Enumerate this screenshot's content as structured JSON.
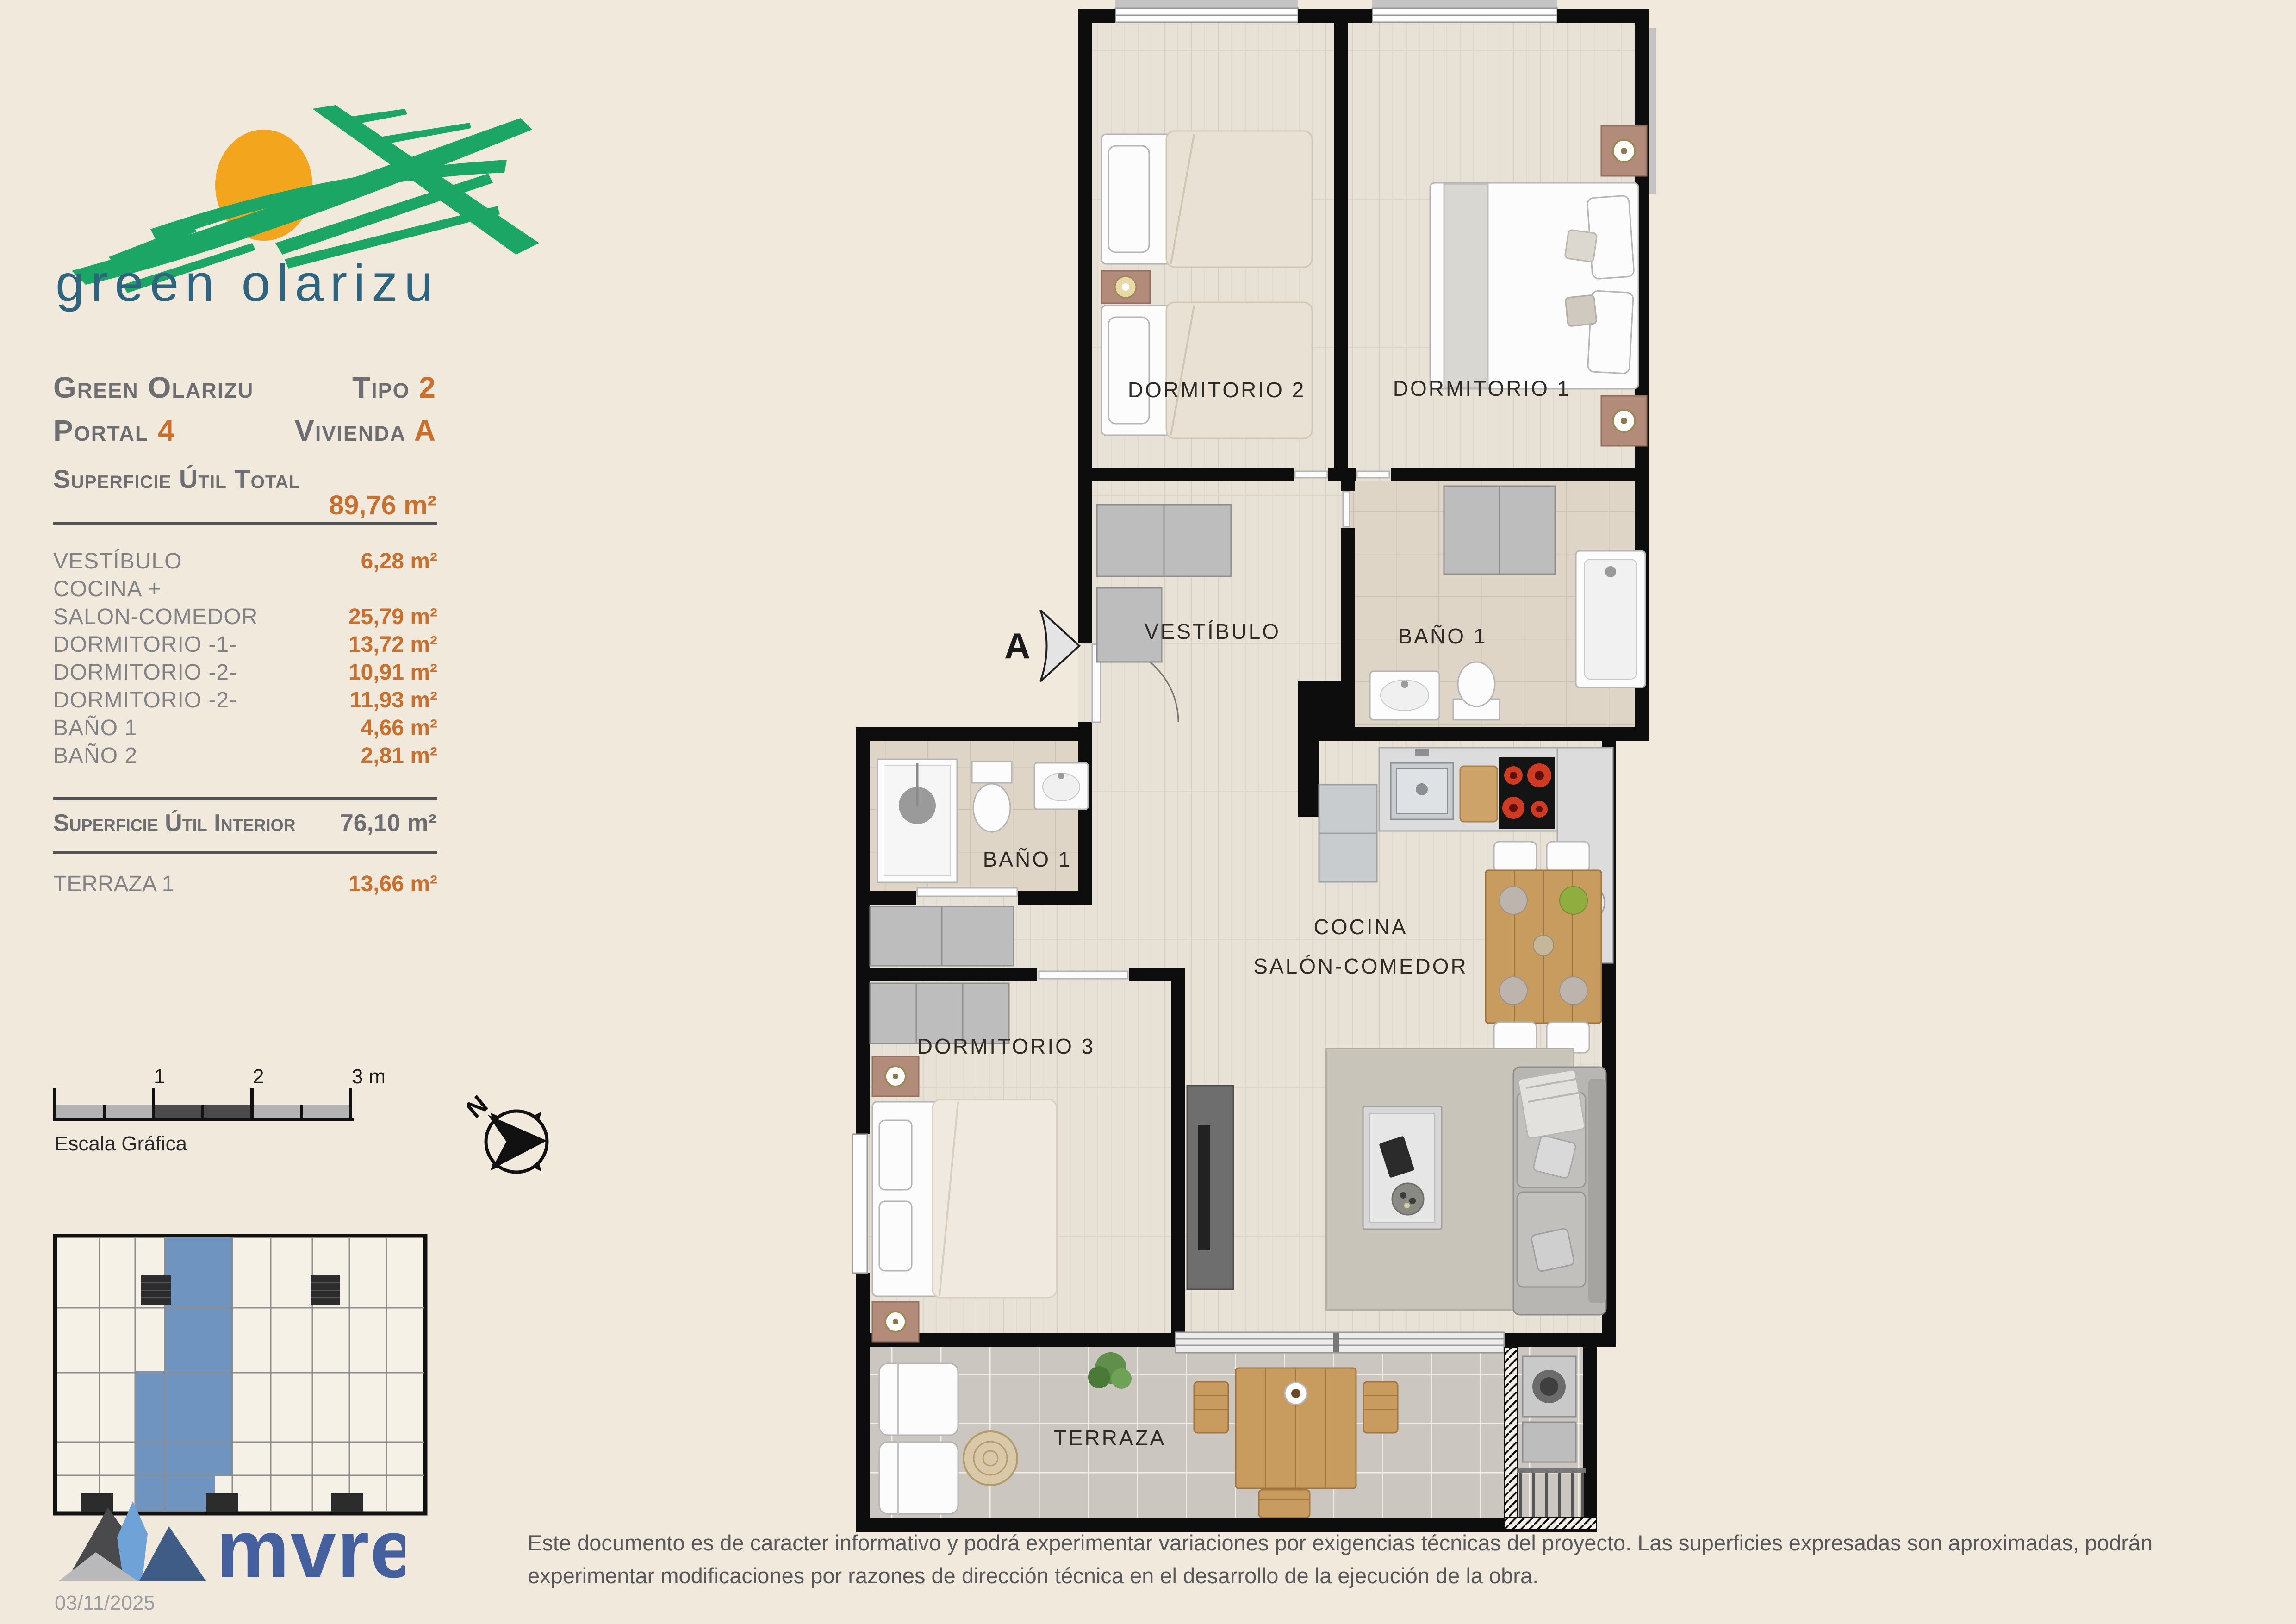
{
  "page": {
    "background": "#f1e9dc"
  },
  "brand": {
    "logo_text": "green olarizu",
    "logo_green": "#1ba666",
    "logo_sun": "#f3a51d",
    "logo_text_color": "#2d647f"
  },
  "header": {
    "project": "Green Olarizu",
    "tipo_label": "Tipo ",
    "tipo_value": "2",
    "portal_label": "Portal ",
    "portal_value": "4",
    "vivienda_label": "Vivienda ",
    "vivienda_value": "A"
  },
  "areas": {
    "total_label": "Superficie Útil Total",
    "total_value": "89,76 m²",
    "rows": [
      {
        "label": "VESTÍBULO",
        "value": "6,28 m²"
      },
      {
        "label": "COCINA +",
        "value": ""
      },
      {
        "label": "SALON-COMEDOR",
        "value": "25,79 m²"
      },
      {
        "label": "DORMITORIO -1-",
        "value": "13,72 m²"
      },
      {
        "label": "DORMITORIO -2-",
        "value": "10,91 m²"
      },
      {
        "label": "DORMITORIO -2-",
        "value": "11,93 m²"
      },
      {
        "label": "BAÑO 1",
        "value": "4,66 m²"
      },
      {
        "label": "BAÑO 2",
        "value": "2,81 m²"
      }
    ],
    "interior_label": "Superficie Útil Interior",
    "interior_value": "76,10 m²",
    "terrace_label": "TERRAZA 1",
    "terrace_value": "13,66 m²"
  },
  "scalebar": {
    "tick1": "1",
    "tick2": "2",
    "tick3": "3 m.",
    "caption": "Escala Gráfica"
  },
  "north": {
    "label": "N"
  },
  "keyplan": {
    "highlight_color": "#6e94bf"
  },
  "plan": {
    "entry_label": "A",
    "rooms": {
      "dorm2": "DORMITORIO 2",
      "dorm1": "DORMITORIO 1",
      "vestibulo": "VESTÍBULO",
      "bano1_right": "BAÑO 1",
      "cocina": "COCINA",
      "salon": "SALÓN-COMEDOR",
      "bano1_left": "BAÑO 1",
      "dorm3": "DORMITORIO 3",
      "terraza": "TERRAZA"
    }
  },
  "footer": {
    "logo_text": "mvre",
    "date": "03/11/2025",
    "disclaimer": "Este documento es de caracter informativo y podrá experimentar variaciones por exigencias técnicas del proyecto. Las superficies expresadas son aproximadas, podrán experimentar modificaciones por razones de dirección técnica en el desarrollo de la ejecución de la obra."
  }
}
